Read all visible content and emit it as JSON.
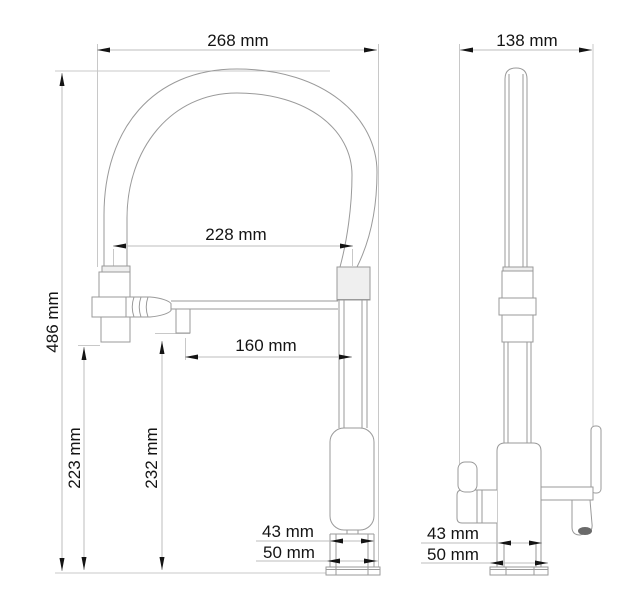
{
  "drawing": {
    "type": "technical-dimension-drawing",
    "subject": "kitchen faucet with flexible spring spout and pull-down sprayer, front and side orthographic views",
    "units": "mm",
    "front_view": {
      "dimensions": {
        "total_width": "268 mm",
        "spout_span": "228 mm",
        "outlet_reach": "160 mm",
        "total_height": "486 mm",
        "spray_head_height": "223 mm",
        "outlet_height": "232 mm",
        "base_width": "43 mm",
        "flange_width": "50 mm"
      }
    },
    "side_view": {
      "dimensions": {
        "total_depth": "138 mm",
        "base_width": "43 mm",
        "flange_width": "50 mm"
      }
    },
    "colors": {
      "background": "#ffffff",
      "object_line": "#9a9a9a",
      "dimension_line": "#bcbcbc",
      "text": "#141414",
      "arrow": "#141414"
    }
  }
}
